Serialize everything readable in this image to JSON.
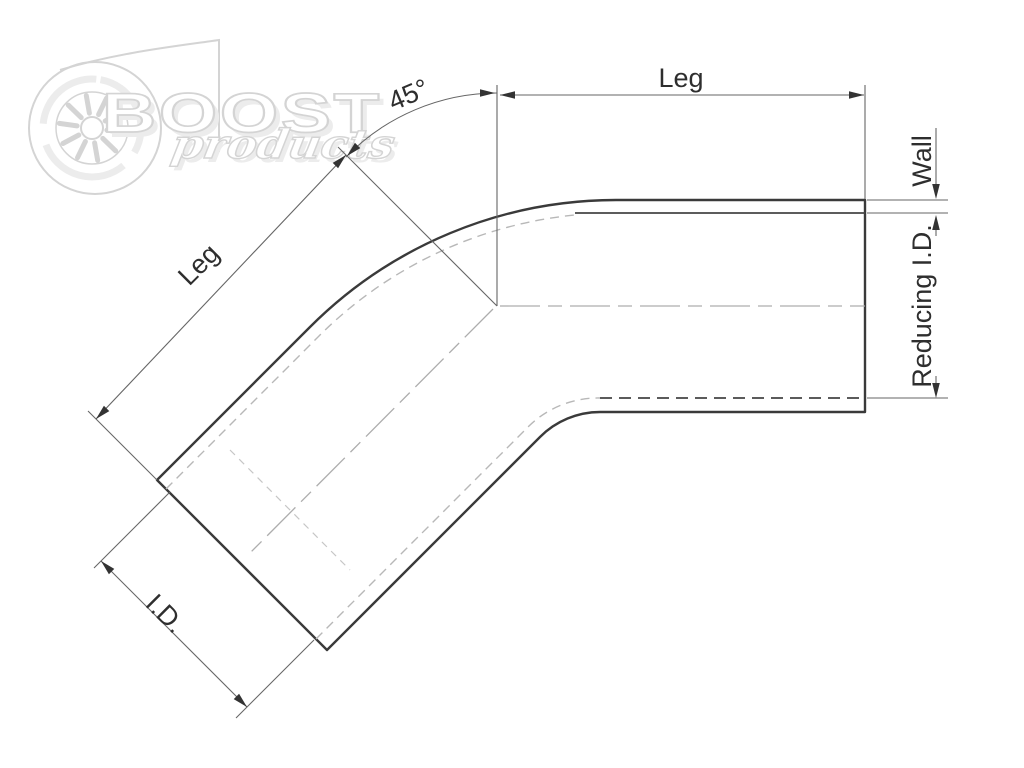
{
  "watermark": {
    "brand": "BOOST",
    "script": "products"
  },
  "labels": {
    "angle": "45°",
    "leg_top": "Leg",
    "leg_diagonal": "Leg",
    "wall": "Wall",
    "reducing_inner_diameter": "Reducing I.D.",
    "inner_diameter": "I.D."
  },
  "colors": {
    "outline": "#3a3a3a",
    "inner-line": "#444444",
    "hidden-line": "#b8b8b8",
    "centerline": "#adadad",
    "dimension": "#666666",
    "label": "#2e2e2e",
    "arrow": "#333333",
    "watermark": "#d4d4d4",
    "watermark-shadow": "#ececec",
    "background": "#ffffff"
  }
}
